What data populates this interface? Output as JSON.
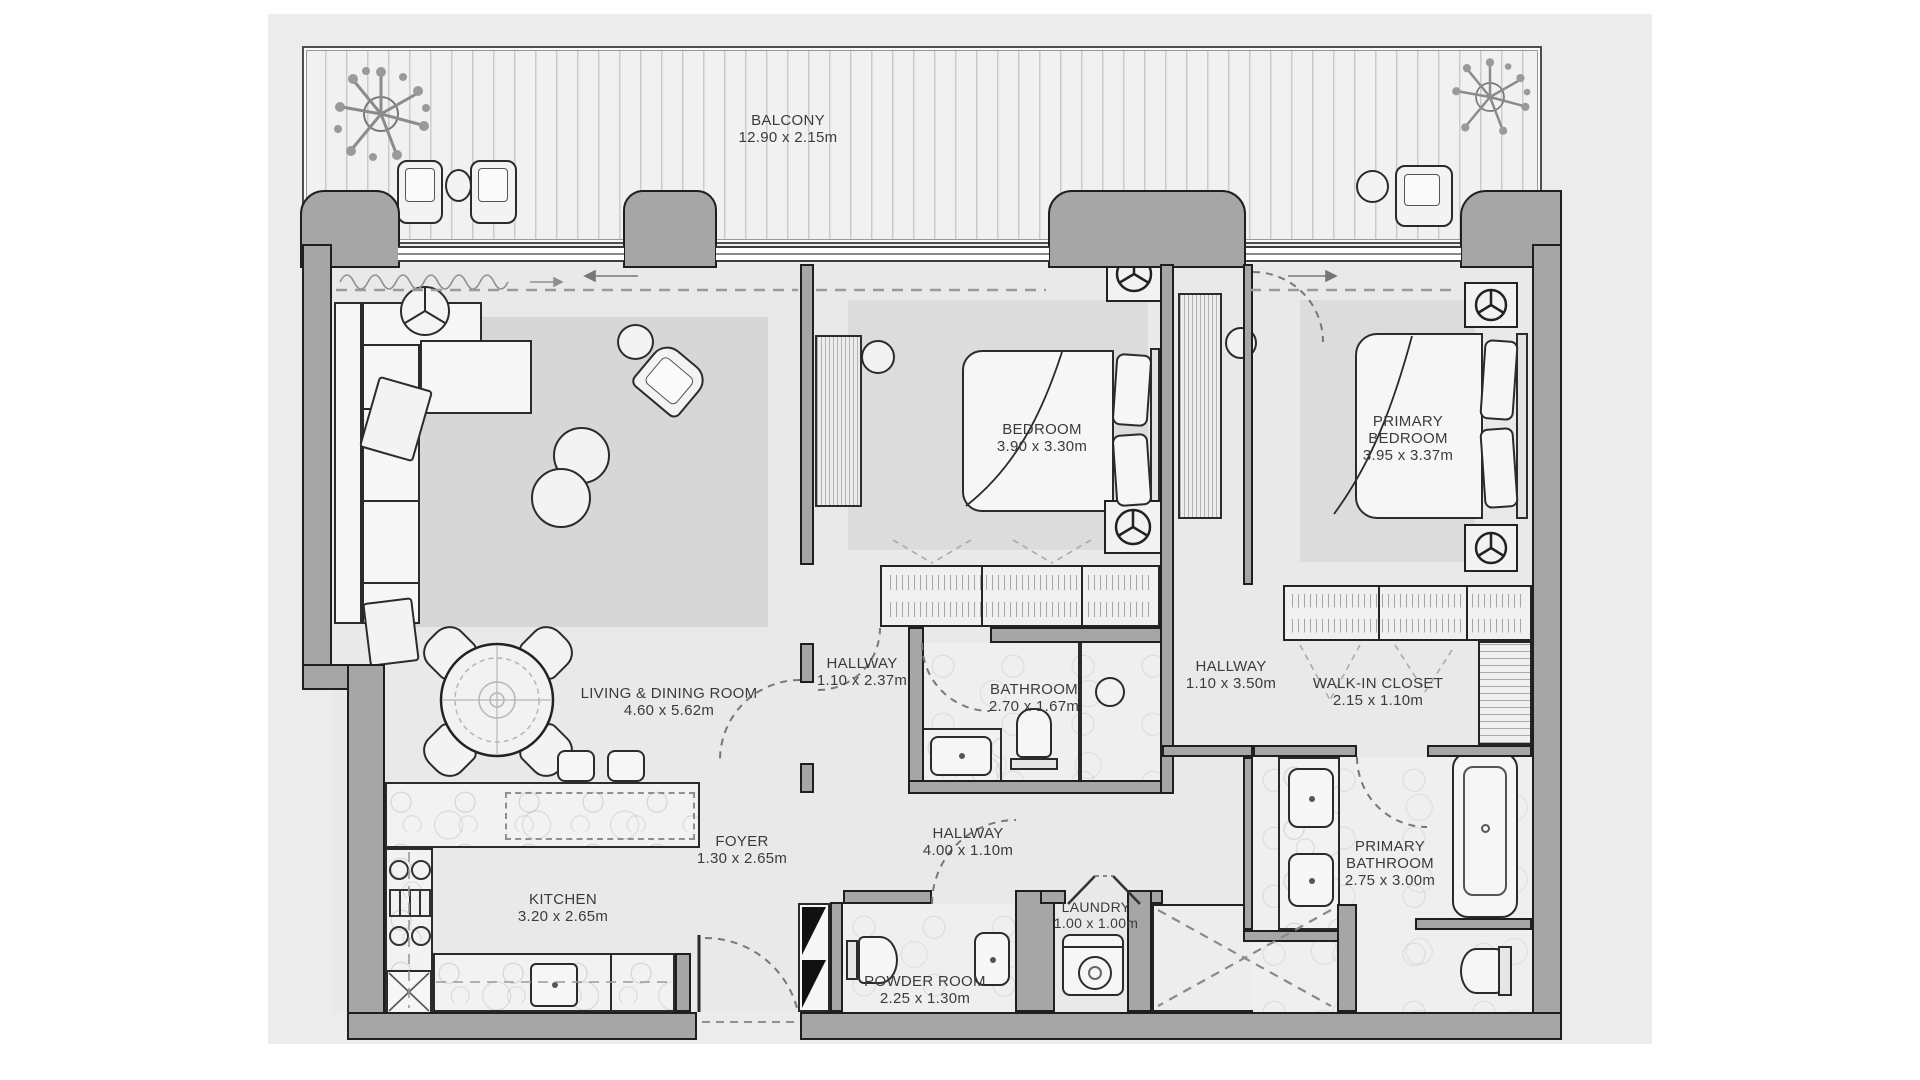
{
  "plan": {
    "rooms": [
      {
        "id": "balcony",
        "name": "BALCONY",
        "dims": "12.90 x 2.15m"
      },
      {
        "id": "living-dining-room",
        "name": "LIVING & DINING ROOM",
        "dims": "4.60 x 5.62m"
      },
      {
        "id": "bedroom",
        "name": "BEDROOM",
        "dims": "3.90 x 3.30m"
      },
      {
        "id": "bathroom",
        "name": "BATHROOM",
        "dims": "2.70 x 1.67m"
      },
      {
        "id": "hallway-bedroom",
        "name": "HALLWAY",
        "dims": "1.10 x 2.37m"
      },
      {
        "id": "hallway-primary",
        "name": "HALLWAY",
        "dims": "1.10 x 3.50m"
      },
      {
        "id": "walk-in-closet",
        "name": "WALK-IN CLOSET",
        "dims": "2.15 x 1.10m"
      },
      {
        "id": "primary-bedroom",
        "name": "PRIMARY BEDROOM",
        "dims": "3.95 x 3.37m"
      },
      {
        "id": "primary-bathroom",
        "name": "PRIMARY BATHROOM",
        "dims": "2.75 x 3.00m"
      },
      {
        "id": "hallway-main",
        "name": "HALLWAY",
        "dims": "4.00 x 1.10m"
      },
      {
        "id": "foyer",
        "name": "FOYER",
        "dims": "1.30 x 2.65m"
      },
      {
        "id": "kitchen",
        "name": "KITCHEN",
        "dims": "3.20 x 2.65m"
      },
      {
        "id": "powder-room",
        "name": "POWDER ROOM",
        "dims": "2.25 x 1.30m"
      },
      {
        "id": "laundry",
        "name": "LAUNDRY",
        "dims": "1.00 x 1.00m"
      }
    ],
    "colors": {
      "sheet": "#ececec",
      "wall": "#a6a6a6",
      "wall_outline": "#1f1f1f",
      "floor": "#e9e9e9",
      "rug": "#d7d7d7",
      "deck": "#f1f1f1",
      "label_ink": "#3b3b3b"
    }
  }
}
